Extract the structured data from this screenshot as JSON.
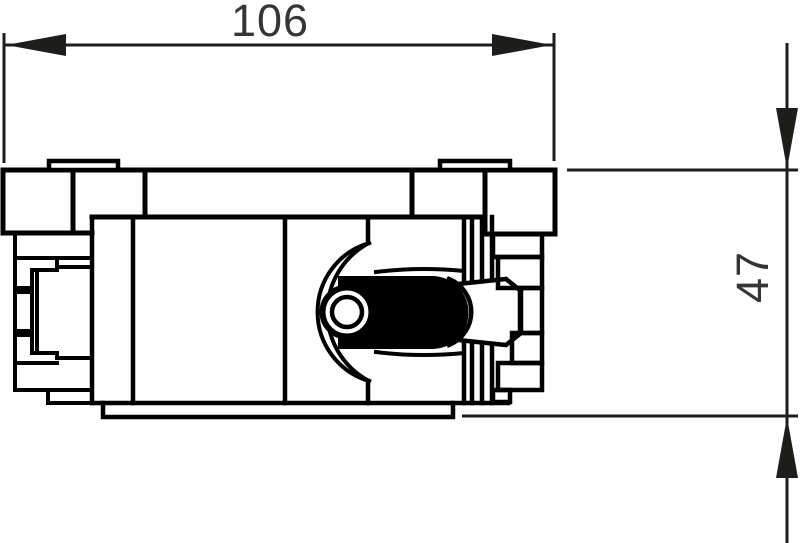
{
  "drawing": {
    "title": "dimensioned-part-side-view",
    "type": "technical-drawing",
    "background": "#ffffff",
    "line_color": "#000000",
    "dimension_line_color": "#1d1d1b",
    "text_color": "#353533",
    "dimensions": {
      "width": {
        "label": "106"
      },
      "height": {
        "label": "47"
      }
    }
  }
}
